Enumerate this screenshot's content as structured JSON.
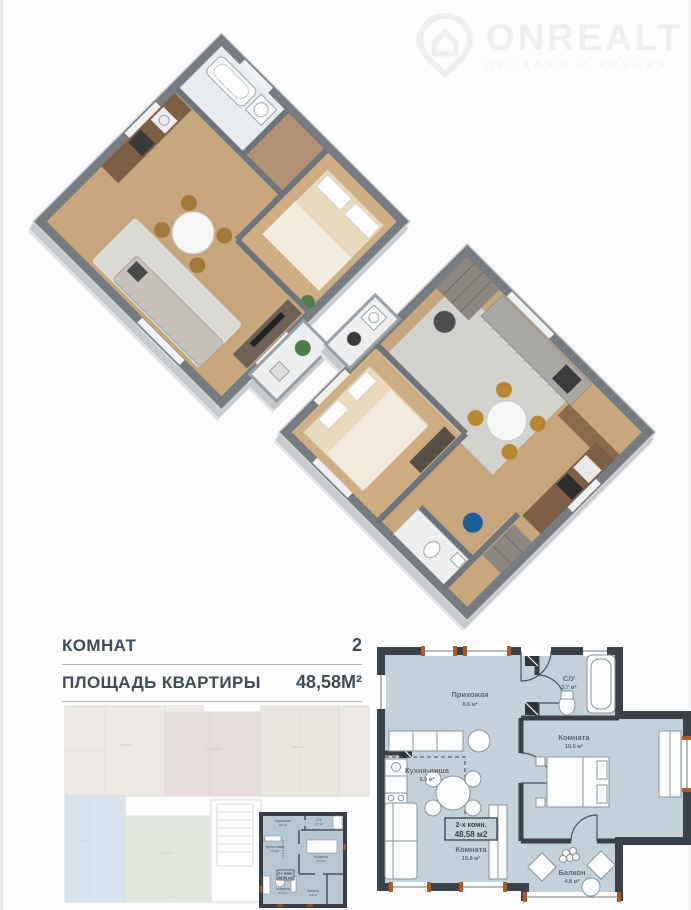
{
  "watermark": {
    "brand": "ONREALT",
    "tagline": "ПРОДАЖА И АРЕНДА"
  },
  "summary": {
    "rows": [
      {
        "label": "КОМНАТ",
        "value": "2"
      },
      {
        "label": "ПЛОЩАДЬ КВАРТИРЫ",
        "value": "48,58М²"
      }
    ]
  },
  "detail_plan": {
    "unit_type": "2-х комн.",
    "unit_area": "48.58 м2",
    "rooms": [
      {
        "name": "Прихожая",
        "area": "8.6 м²"
      },
      {
        "name": "С/У",
        "area": "3.7 м²"
      },
      {
        "name": "Кухня-ниша",
        "area": "5.3 м²"
      },
      {
        "name": "Комната",
        "area": "15.8 м²"
      },
      {
        "name": "Комната",
        "area": "10.5 м²"
      },
      {
        "name": "Балкон",
        "area": "4.8 м²"
      }
    ]
  },
  "colors": {
    "wall": "#3b4148",
    "room_fill": "#c3d1da",
    "window_accent": "#b05a26",
    "text": "#3f4c55",
    "wood_floor": "#c7a67c",
    "mini_highlight": "#b6c6d2"
  }
}
